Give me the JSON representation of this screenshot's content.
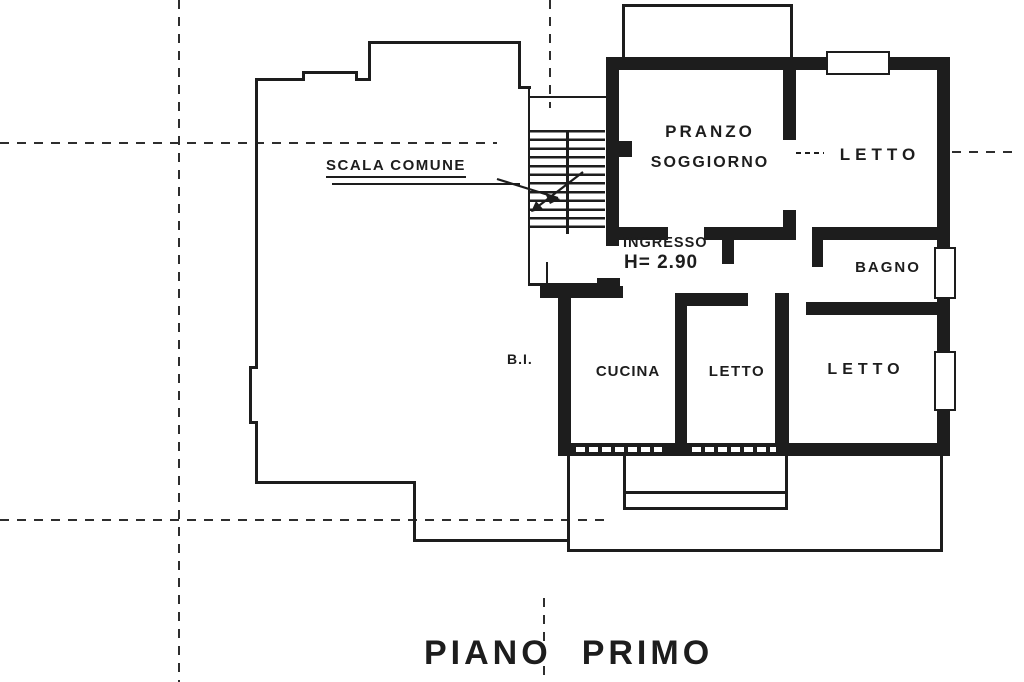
{
  "colors": {
    "ink": "#1d1d1d",
    "paper": "#ffffff",
    "grid_line": "#2e2e2e"
  },
  "annotations": {
    "scala_comune": "SCALA COMUNE",
    "bi": "B.I.",
    "ingresso": "INGRESSO",
    "height_note": "H= 2.90"
  },
  "rooms": {
    "pranzo_soggiorno_line1": "PRANZO",
    "pranzo_soggiorno_line2": "SOGGIORNO",
    "letto_top": "LETTO",
    "bagno": "BAGNO",
    "cucina": "CUCINA",
    "letto_middle": "LETTO",
    "letto_right": "LETTO"
  },
  "title": {
    "word1": "PIANO",
    "word2": "PRIMO"
  }
}
